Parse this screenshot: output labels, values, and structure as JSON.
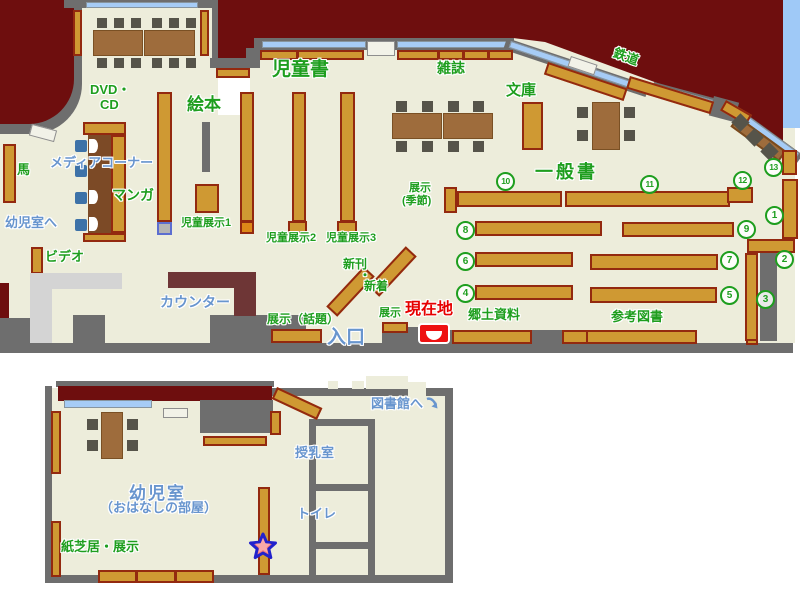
{
  "labels": {
    "children_books": "児童書",
    "magazines": "雑誌",
    "bunko": "文庫",
    "railway": "鉄道",
    "picture_books": "絵本",
    "dvd": "DVD・",
    "cd": "CD",
    "media_corner": "メディアコーナー",
    "manga": "マンガ",
    "horse": "馬",
    "to_infant_room": "幼児室へ",
    "video": "ビデオ",
    "counter": "カウンター",
    "children_display1": "児童展示1",
    "children_display2": "児童展示2",
    "children_display3": "児童展示3",
    "new_arrivals_1": "新刊",
    "new_arrivals_dot": "・",
    "new_arrivals_2": "新着",
    "display_seasonal_1": "展示",
    "display_seasonal_2": "(季節)",
    "display_topical": "展示（話題）",
    "display": "展示",
    "current_location": "現在地",
    "entrance": "入口",
    "local_materials": "郷土資料",
    "reference_books": "参考図書",
    "general_books": "一般書",
    "to_library": "図書館へ",
    "nursing_room": "授乳室",
    "toilet": "トイレ",
    "infant_room": "幼児室",
    "storytelling_room": "（おはなしの部屋）",
    "kamishibai_display": "紙芝居・展示"
  },
  "numbers": {
    "n1": "1",
    "n2": "2",
    "n3": "3",
    "n4": "4",
    "n5": "5",
    "n6": "6",
    "n7": "7",
    "n8": "8",
    "n9": "9",
    "n10": "10",
    "n11": "11",
    "n12": "12",
    "n13": "13"
  },
  "palette": {
    "floor": "#EDEDDB",
    "outside": "#6E0E0E",
    "wall": "#6E6E6E",
    "shelf": "#CF9933",
    "shelf_border": "#93290F",
    "window": "#A6CCF6",
    "sky": "#9FC9F7",
    "table": "#9E6C3C",
    "chair": "#56544A",
    "media_chair": "#3D72A8",
    "counter": "#6E3636",
    "green_text": "#1E9E1E",
    "blue_text": "#6895CE",
    "red_text": "#E60000",
    "marker_red": "#EE1111"
  }
}
